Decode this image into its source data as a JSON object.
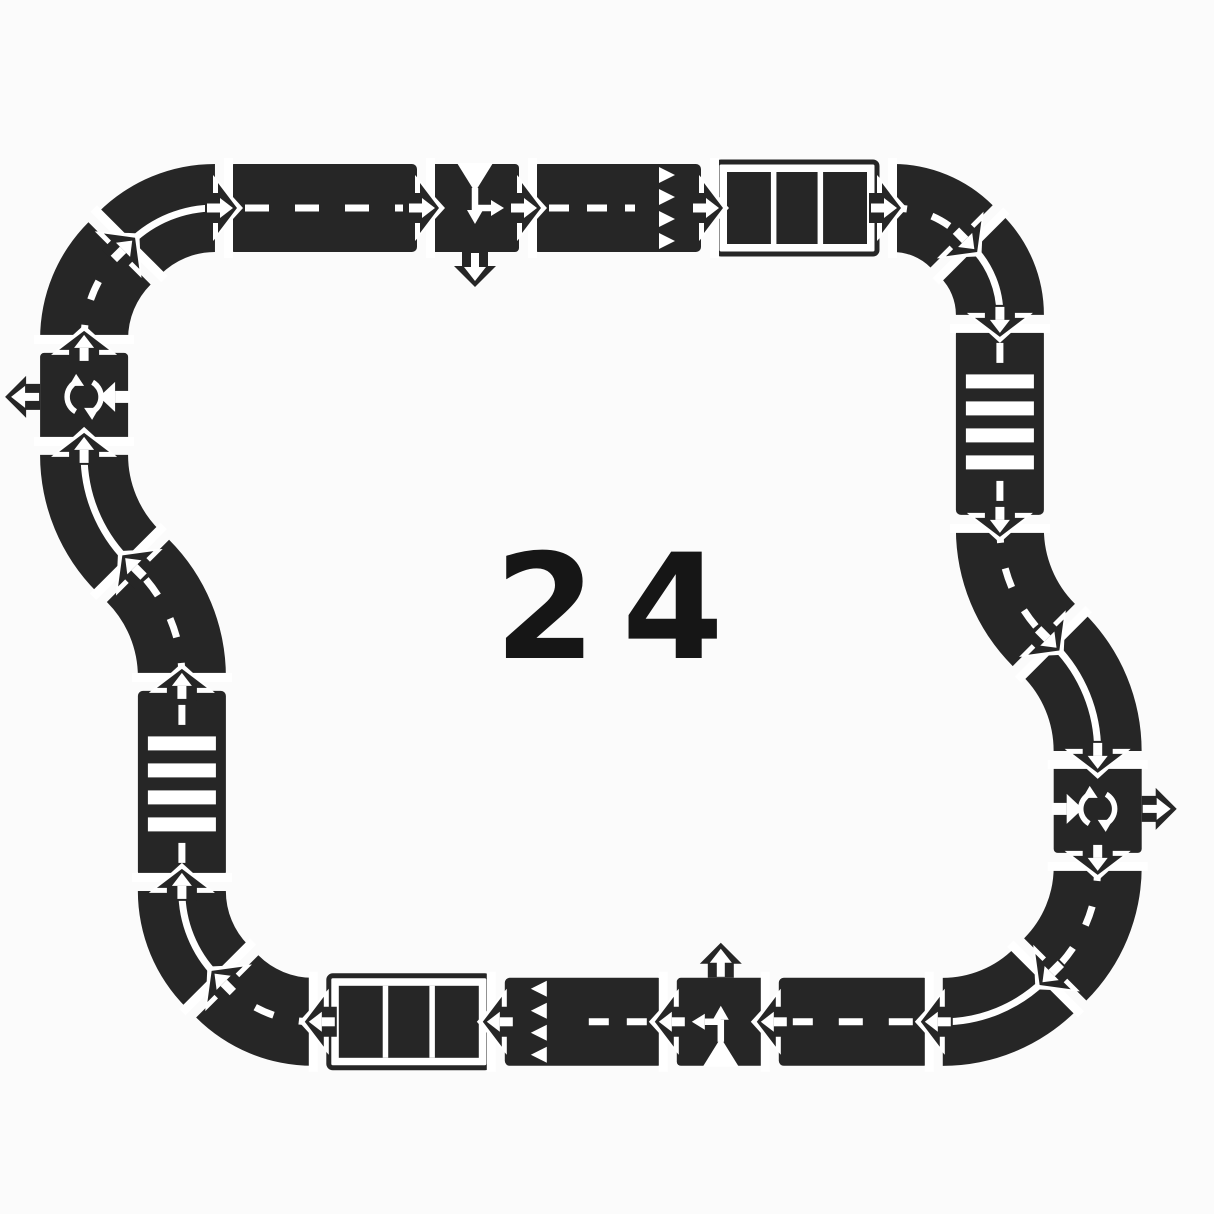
{
  "image": {
    "background": "#fbfbfb"
  },
  "center_label": {
    "text": "24",
    "color": "#161616"
  },
  "track": {
    "road_color": "#262626",
    "marking_color": "#ffffff",
    "road_width": 88,
    "piece_count": 24,
    "pieces": [
      {
        "name": "piece-curve-top-left-lower",
        "type": "curve",
        "marking": "dashed",
        "x": 84.1,
        "y": 338.9,
        "heading": 270,
        "radius": 121,
        "turn": "right"
      },
      {
        "name": "piece-curve-top-left-upper",
        "type": "curve",
        "marking": "solid",
        "x": 129.4,
        "y": 243.4,
        "heading": 315,
        "radius": 121,
        "turn": "right"
      },
      {
        "name": "piece-straight-top",
        "type": "straight",
        "marking": "dashed",
        "x": 229,
        "y": 208,
        "heading": 0,
        "length": 188
      },
      {
        "name": "piece-tee-junction-top",
        "type": "tee",
        "marking": "none",
        "x": 431,
        "y": 208,
        "heading": 0
      },
      {
        "name": "piece-straight-top-give-way",
        "type": "straight",
        "marking": "give-way",
        "x": 533,
        "y": 208,
        "heading": 0,
        "length": 168
      },
      {
        "name": "piece-parking-top",
        "type": "parking",
        "marking": "none",
        "x": 715,
        "y": 208,
        "heading": 0,
        "length": 164
      },
      {
        "name": "piece-curve-top-right-first",
        "type": "curve",
        "marking": "dashed",
        "x": 893,
        "y": 208,
        "heading": 0,
        "radius": 97,
        "turn": "right"
      },
      {
        "name": "piece-curve-top-right-second",
        "type": "curve",
        "marking": "solid",
        "x": 971.5,
        "y": 246.3,
        "heading": 45,
        "radius": 97,
        "turn": "right"
      },
      {
        "name": "piece-zebra-crossing-right",
        "type": "straight",
        "marking": "zebra",
        "x": 999.9,
        "y": 328.9,
        "heading": 90,
        "length": 186
      },
      {
        "name": "piece-s-curve-right-first",
        "type": "curve",
        "marking": "dashed",
        "x": 999.9,
        "y": 528.9,
        "heading": 90,
        "radius": 150,
        "turn": "left"
      },
      {
        "name": "piece-s-curve-right-second",
        "type": "curve",
        "marking": "solid",
        "x": 1053.7,
        "y": 644.9,
        "heading": 45,
        "radius": 150,
        "turn": "right"
      },
      {
        "name": "piece-roundabout-right",
        "type": "roundabout",
        "marking": "none",
        "x": 1097.7,
        "y": 764.9,
        "heading": 90
      },
      {
        "name": "piece-curve-bottom-right-first",
        "type": "curve",
        "marking": "dashed",
        "x": 1097.7,
        "y": 866.9,
        "heading": 90,
        "radius": 145,
        "turn": "right"
      },
      {
        "name": "piece-curve-bottom-right-second",
        "type": "curve",
        "marking": "solid",
        "x": 1045.3,
        "y": 979.4,
        "heading": 135,
        "radius": 145,
        "turn": "right"
      },
      {
        "name": "piece-straight-bottom",
        "type": "straight",
        "marking": "dashed",
        "x": 928.8,
        "y": 1021.8,
        "heading": 180,
        "length": 150
      },
      {
        "name": "piece-tee-junction-bottom",
        "type": "tee",
        "marking": "none",
        "x": 764.8,
        "y": 1021.8,
        "heading": 180
      },
      {
        "name": "piece-straight-bottom-give-way",
        "type": "straight",
        "marking": "give-way",
        "x": 662.8,
        "y": 1021.8,
        "heading": 180,
        "length": 158
      },
      {
        "name": "piece-parking-bottom",
        "type": "parking",
        "marking": "none",
        "x": 490.8,
        "y": 1021.8,
        "heading": 180,
        "length": 164
      },
      {
        "name": "piece-curve-bottom-left-first",
        "type": "curve",
        "marking": "dashed",
        "x": 312.8,
        "y": 1021.8,
        "heading": 180,
        "radius": 121,
        "turn": "right"
      },
      {
        "name": "piece-curve-bottom-left-second",
        "type": "curve",
        "marking": "solid",
        "x": 217.3,
        "y": 976.5,
        "heading": 225,
        "radius": 121,
        "turn": "right"
      },
      {
        "name": "piece-zebra-crossing-left",
        "type": "straight",
        "marking": "zebra",
        "x": 181.9,
        "y": 876.9,
        "heading": 270,
        "length": 186
      },
      {
        "name": "piece-s-curve-left-first",
        "type": "curve",
        "marking": "dashed",
        "x": 181.9,
        "y": 676.9,
        "heading": 270,
        "radius": 150,
        "turn": "left"
      },
      {
        "name": "piece-s-curve-left-second",
        "type": "curve",
        "marking": "solid",
        "x": 128.0,
        "y": 561.0,
        "heading": 225,
        "radius": 150,
        "turn": "right"
      },
      {
        "name": "piece-roundabout-left",
        "type": "roundabout",
        "marking": "none",
        "x": 84.1,
        "y": 440.9,
        "heading": 270
      }
    ]
  }
}
